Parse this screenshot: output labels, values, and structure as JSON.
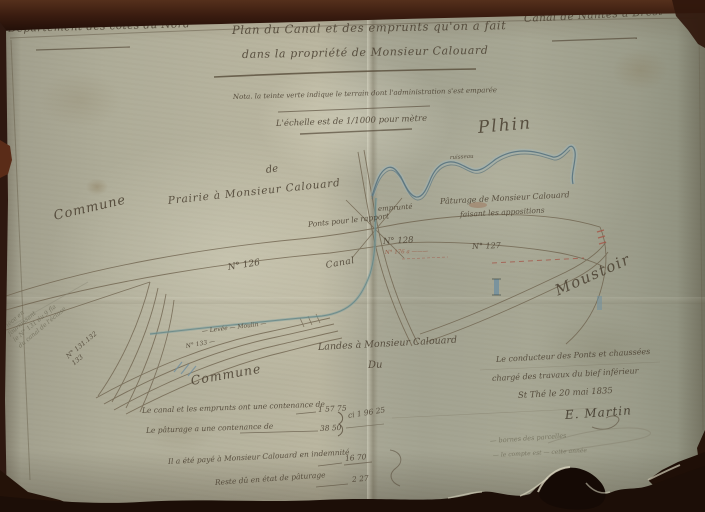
{
  "colors": {
    "background": "#2b150d",
    "paper": "#b2af9a",
    "ink": "#4c4233",
    "river_blue": "#54707c",
    "red_annotation": "#a4584a",
    "pencil": "#75735f"
  },
  "header": {
    "department": "Département des côtes du Nord",
    "canal": "Canal de Nantes à Brest",
    "title1": "Plan du Canal et des emprunts qu'on a fait",
    "title2": "dans la propriété de Monsieur Calouard",
    "nota": "Nota. la teinte verte indique le terrain dont l'administration s'est emparée",
    "scale": "L'échelle est de 1/1000 pour mètre"
  },
  "labels": {
    "plhin": "Plhin",
    "moustoir": "Moustoir",
    "commune_left": "Commune",
    "de": "de",
    "prairie": "Prairie à Monsieur Calouard",
    "paturage1": "Pâturage de Monsieur Calouard",
    "paturage2": "faisant les appositions",
    "emprunte": "emprunté",
    "ponts": "Ponts pour le rapport",
    "canal": "Canal",
    "ruisseau": "ruisseau",
    "commune_bottom": "Commune",
    "landes": "Landes à Monsieur Calouard",
    "du": "Du"
  },
  "parcels": {
    "n126": "N° 126",
    "n127": "N° 127",
    "n128": "N° 128",
    "n176": "N° 176 a ———",
    "n131a": "N° 131.132",
    "n131b": "133",
    "n133": "N° 133 —",
    "towpath": "— Levée — Moulin —"
  },
  "notes": {
    "piece1": "Pièce en",
    "piece2": "fournissant",
    "piece3": "le N° 131 du 9 fla",
    "piece4": "du canal de l'écluse"
  },
  "measurements": {
    "m1_label": "Le canal et les emprunts ont une contenance de",
    "m1_value": "1 57 75",
    "m2_label": "Le pâturage a une contenance de",
    "m2_value": "38 50",
    "total": "ci 1 96 25",
    "paid_label": "Il a été payé à Monsieur Calouard en indemnité",
    "paid_value": "16 70",
    "rest_label": "Reste dû en état de pâturage",
    "rest_value": "2 27"
  },
  "signature": {
    "line1": "Le conducteur des Ponts et chaussées",
    "line2": "chargé des travaux du bief inférieur",
    "date": "St Thé le 20 mai 1835",
    "name": "E. Martin"
  },
  "pencil_notes": {
    "line1": "— bornes des parcelles",
    "line2": "— le compte est — cette année"
  }
}
